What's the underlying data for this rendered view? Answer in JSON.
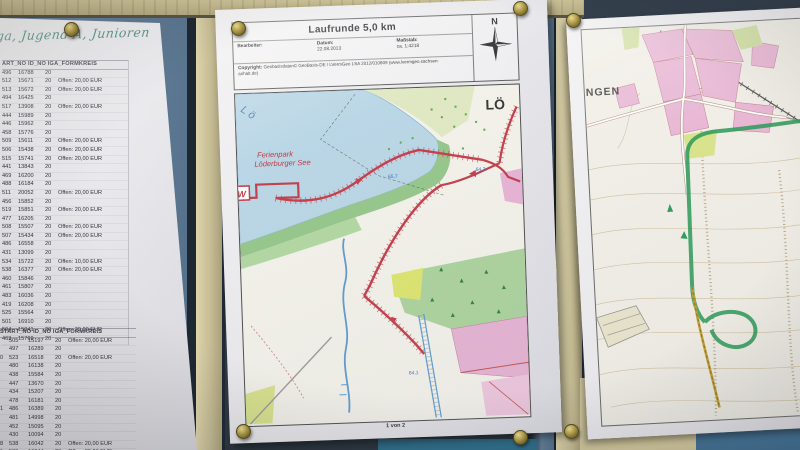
{
  "colors": {
    "board_navy": "#2b3644",
    "panel_blue": "#5e7a97",
    "panel_teal": "#2a6a88",
    "panel_steel_blue": "#47799f",
    "wood_beam": "#bdb288",
    "frame_beige": "#cac19a",
    "paper_white": "#edecef",
    "pin_brass": "#9c8a3a",
    "route_red": "#c23b49",
    "route_green": "#2a9a58",
    "lake_blue": "#b9d7e8",
    "forest_green": "#a8d29b",
    "village_pink": "#e7b3d5",
    "handwriting_green": "#2e7f6d"
  },
  "left_paper": {
    "handwriting": "ga, Jugend A, Junioren",
    "table1": {
      "header": "ART_NO  ID_NO  IGA_FORMKREIS",
      "rows": [
        [
          "496",
          "16788",
          "20",
          ""
        ],
        [
          "512",
          "15671",
          "20",
          "Offen: 20,00 EUR"
        ],
        [
          "513",
          "15672",
          "20",
          "Offen: 20,00 EUR"
        ],
        [
          "494",
          "16425",
          "20",
          ""
        ],
        [
          "517",
          "13908",
          "20",
          "Offen: 20,00 EUR"
        ],
        [
          "444",
          "15989",
          "20",
          ""
        ],
        [
          "446",
          "15962",
          "20",
          ""
        ],
        [
          "458",
          "15776",
          "20",
          ""
        ],
        [
          "509",
          "15611",
          "20",
          "Offen: 20,00 EUR"
        ],
        [
          "506",
          "15438",
          "20",
          "Offen: 20,00 EUR"
        ],
        [
          "515",
          "15741",
          "20",
          "Offen: 20,00 EUR"
        ],
        [
          "441",
          "13843",
          "20",
          ""
        ],
        [
          "469",
          "16200",
          "20",
          ""
        ],
        [
          "488",
          "16184",
          "20",
          ""
        ],
        [
          "511",
          "20052",
          "20",
          "Offen: 20,00 EUR"
        ],
        [
          "456",
          "15852",
          "20",
          ""
        ],
        [
          "519",
          "15851",
          "20",
          "Offen: 20,00 EUR"
        ],
        [
          "477",
          "16205",
          "20",
          ""
        ],
        [
          "508",
          "15507",
          "20",
          "Offen: 20,00 EUR"
        ],
        [
          "507",
          "15434",
          "20",
          "Offen: 20,00 EUR"
        ],
        [
          "486",
          "16558",
          "20",
          ""
        ],
        [
          "431",
          "13099",
          "20",
          ""
        ],
        [
          "534",
          "15722",
          "20",
          "Offen: 10,00 EUR"
        ],
        [
          "538",
          "16377",
          "20",
          "Offen: 20,00 EUR"
        ],
        [
          "460",
          "15846",
          "20",
          ""
        ],
        [
          "461",
          "15807",
          "20",
          ""
        ],
        [
          "483",
          "16036",
          "20",
          ""
        ],
        [
          "419",
          "16208",
          "20",
          ""
        ],
        [
          "525",
          "15564",
          "20",
          ""
        ],
        [
          "501",
          "16910",
          "20",
          ""
        ],
        [
          "504",
          "15041",
          "20",
          "Offen: 20,00 EUR"
        ],
        [
          "463",
          "15769",
          "20",
          ""
        ]
      ]
    },
    "table2": {
      "header": "START_NO  ID_NO  IGA_FORMKREIS",
      "rows": [
        [
          "",
          "505",
          "15197",
          "20",
          "Offen: 20,00 EUR"
        ],
        [
          "",
          "497",
          "16289",
          "20",
          ""
        ],
        [
          "0",
          "523",
          "16518",
          "20",
          "Offen: 20,00 EUR"
        ],
        [
          "",
          "480",
          "16138",
          "20",
          ""
        ],
        [
          "",
          "438",
          "15584",
          "20",
          ""
        ],
        [
          "",
          "447",
          "13670",
          "20",
          ""
        ],
        [
          "",
          "434",
          "15207",
          "20",
          ""
        ],
        [
          "",
          "478",
          "16181",
          "20",
          ""
        ],
        [
          "1",
          "486",
          "16389",
          "20",
          ""
        ],
        [
          "",
          "481",
          "14998",
          "20",
          ""
        ],
        [
          "",
          "452",
          "15095",
          "20",
          ""
        ],
        [
          "",
          "430",
          "10094",
          "20",
          ""
        ],
        [
          "8",
          "538",
          "16042",
          "20",
          "Offen: 20,00 EUR"
        ],
        [
          "1",
          "539",
          "16044",
          "20",
          "Offen: 20,00 EUR"
        ],
        [
          "0",
          "439",
          "15604",
          "20",
          ""
        ]
      ]
    }
  },
  "map_sheet": {
    "title": "Laufrunde 5,0 km",
    "bearbeiter_label": "Bearbeiter:",
    "datum_label": "Datum:",
    "datum_value": "22.08.2013",
    "massstab_label": "Maßstab:",
    "massstab_value": "ca. 1:4218",
    "copyright_label": "Copyright:",
    "copyright_line1": "Geobasisdaten© GeoBasis-DE / LVermGeo LSA 2012/010809 (www.lvermgeo.sachsen-",
    "copyright_line2": "anhalt.de)",
    "compass_n": "N",
    "page_indicator": "1 von 2",
    "map_labels": {
      "lake_initials": "L ö",
      "resort_line1": "Ferienpark",
      "resort_line2": "Löderburger See",
      "town_partial": "LÖ",
      "elevation_a": "65,7",
      "elevation_b": "64,2",
      "elevation_c": "64,1",
      "start_marker": "W"
    }
  },
  "right_sheet": {
    "town_label": "NGEN"
  }
}
